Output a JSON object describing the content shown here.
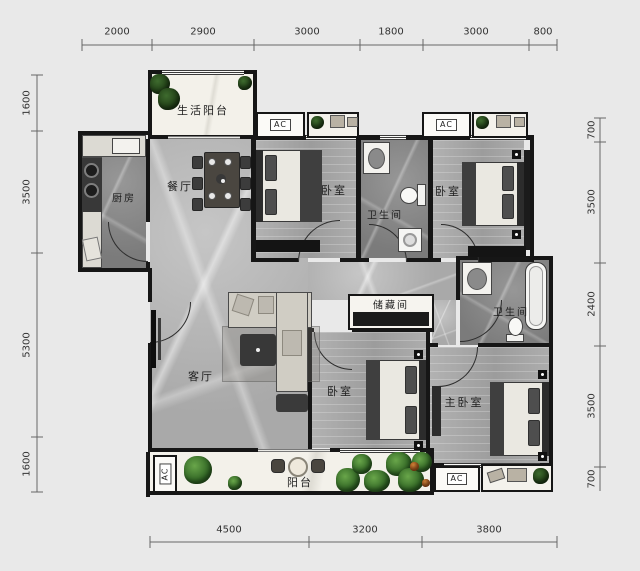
{
  "plan": {
    "type": "residential-floor-plan",
    "rooms": {
      "life_balcony": {
        "label": "生活阳台"
      },
      "kitchen": {
        "label": "厨房"
      },
      "dining": {
        "label": "餐厅"
      },
      "bedroom_top_left": {
        "label": "卧室"
      },
      "bathroom_top": {
        "label": "卫生间"
      },
      "bedroom_top_right": {
        "label": "卧室"
      },
      "bathroom_right": {
        "label": "卫生间"
      },
      "storage": {
        "label": "储藏间"
      },
      "living": {
        "label": "客厅"
      },
      "bedroom_bottom": {
        "label": "卧室"
      },
      "master_bedroom": {
        "label": "主卧室"
      },
      "balcony": {
        "label": "阳台"
      }
    },
    "ac_units": {
      "label": "AC",
      "count": 4
    },
    "dimensions": {
      "top": [
        "2000",
        "2900",
        "3000",
        "1800",
        "3000",
        "800"
      ],
      "bottom": [
        "4500",
        "3200",
        "3800"
      ],
      "left": [
        "1600",
        "3500",
        "5300",
        "1600"
      ],
      "right": [
        "700",
        "3500",
        "2400",
        "3500",
        "700"
      ]
    },
    "colors": {
      "background": "#e9e9e9",
      "wall": "#161616",
      "marble_floor": "#b5b5b5",
      "wood_floor": "#a7a7a7",
      "dark_floor": "#898989",
      "balcony_floor": "#f3f1ea",
      "plant_green": "#3f7d2e",
      "dimension_text": "#333333"
    }
  }
}
